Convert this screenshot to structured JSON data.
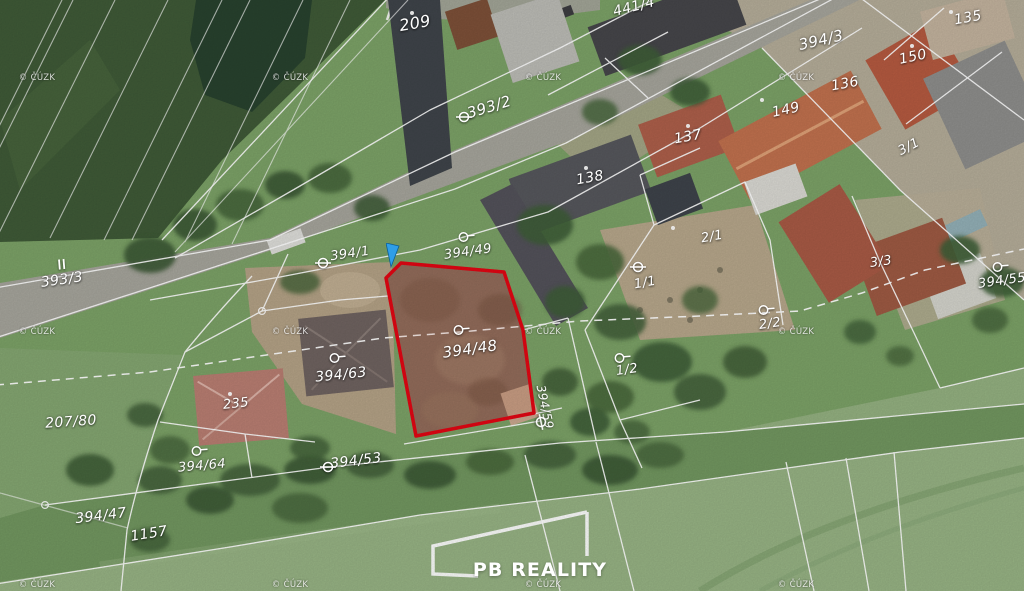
{
  "map": {
    "type": "cadastral-aerial-map",
    "highlight": {
      "parcel": "394/48",
      "color": "#e30613"
    },
    "line_color": "#ffffff",
    "logo": {
      "text": "PB REALITY",
      "x": 540,
      "y": 570
    },
    "watermark": {
      "text": "© ČÚZK",
      "xs": [
        37,
        290,
        543,
        796
      ],
      "ys": [
        78,
        332,
        585
      ]
    },
    "cursor": {
      "name": "map-pointer",
      "x": 386,
      "y": 243,
      "color": "#2f9ee8"
    },
    "labels": [
      {
        "text": "209",
        "x": 415,
        "y": 23,
        "rot": -10,
        "size": 16
      },
      {
        "text": "441/4",
        "x": 634,
        "y": 7,
        "rot": -14,
        "size": 14
      },
      {
        "text": "393/2",
        "x": 489,
        "y": 107,
        "rot": -17,
        "size": 15,
        "sym": "theta",
        "sx": 464,
        "sy": 117
      },
      {
        "text": "394/3",
        "x": 821,
        "y": 40,
        "rot": -13,
        "size": 15
      },
      {
        "text": "135",
        "x": 968,
        "y": 18,
        "rot": -10,
        "size": 14
      },
      {
        "text": "150",
        "x": 913,
        "y": 57,
        "rot": -12,
        "size": 14
      },
      {
        "text": "136",
        "x": 845,
        "y": 84,
        "rot": -10,
        "size": 14
      },
      {
        "text": "149",
        "x": 786,
        "y": 110,
        "rot": -12,
        "size": 14
      },
      {
        "text": "137",
        "x": 688,
        "y": 137,
        "rot": -10,
        "size": 14
      },
      {
        "text": "138",
        "x": 590,
        "y": 178,
        "rot": -10,
        "size": 14
      },
      {
        "text": "3/1",
        "x": 909,
        "y": 147,
        "rot": -28,
        "size": 13
      },
      {
        "text": "393/3",
        "x": 62,
        "y": 280,
        "rot": -8,
        "size": 14,
        "sym": "parallel",
        "sx": 61,
        "sy": 264
      },
      {
        "text": "394/1",
        "x": 350,
        "y": 254,
        "rot": -8,
        "size": 13,
        "sym": "theta",
        "sx": 323,
        "sy": 263
      },
      {
        "text": "394/49",
        "x": 468,
        "y": 252,
        "rot": -8,
        "size": 13,
        "sym": "circle",
        "sx": 466,
        "sy": 237
      },
      {
        "text": "2/1",
        "x": 712,
        "y": 237,
        "rot": -10,
        "size": 13
      },
      {
        "text": "1/1",
        "x": 645,
        "y": 283,
        "rot": -10,
        "size": 13,
        "sym": "theta",
        "sx": 638,
        "sy": 267
      },
      {
        "text": "3/3",
        "x": 881,
        "y": 262,
        "rot": -8,
        "size": 13
      },
      {
        "text": "394/55",
        "x": 1002,
        "y": 281,
        "rot": -8,
        "size": 13,
        "sym": "circle",
        "sx": 1000,
        "sy": 267
      },
      {
        "text": "2/2",
        "x": 770,
        "y": 324,
        "rot": -8,
        "size": 13,
        "sym": "circle",
        "sx": 766,
        "sy": 310
      },
      {
        "text": "394/48",
        "x": 470,
        "y": 349,
        "rot": -8,
        "size": 15,
        "sym": "circle",
        "sx": 461,
        "sy": 330
      },
      {
        "text": "394/63",
        "x": 341,
        "y": 375,
        "rot": -6,
        "size": 14,
        "sym": "circle",
        "sx": 337,
        "sy": 358
      },
      {
        "text": "1/2",
        "x": 627,
        "y": 370,
        "rot": -8,
        "size": 13,
        "sym": "circle",
        "sx": 622,
        "sy": 358
      },
      {
        "text": "235",
        "x": 236,
        "y": 404,
        "rot": -6,
        "size": 13
      },
      {
        "text": "207/80",
        "x": 71,
        "y": 422,
        "rot": -4,
        "size": 14
      },
      {
        "text": "394/64",
        "x": 202,
        "y": 466,
        "rot": -5,
        "size": 13,
        "sym": "circle",
        "sx": 199,
        "sy": 451
      },
      {
        "text": "394/59",
        "x": 545,
        "y": 407,
        "rot": 78,
        "size": 12,
        "sym": "theta",
        "sx": 541,
        "sy": 422
      },
      {
        "text": "394/53",
        "x": 356,
        "y": 461,
        "rot": -7,
        "size": 14,
        "sym": "theta",
        "sx": 328,
        "sy": 467
      },
      {
        "text": "394/47",
        "x": 101,
        "y": 516,
        "rot": -7,
        "size": 14
      },
      {
        "text": "1157",
        "x": 149,
        "y": 534,
        "rot": -9,
        "size": 14
      }
    ]
  }
}
